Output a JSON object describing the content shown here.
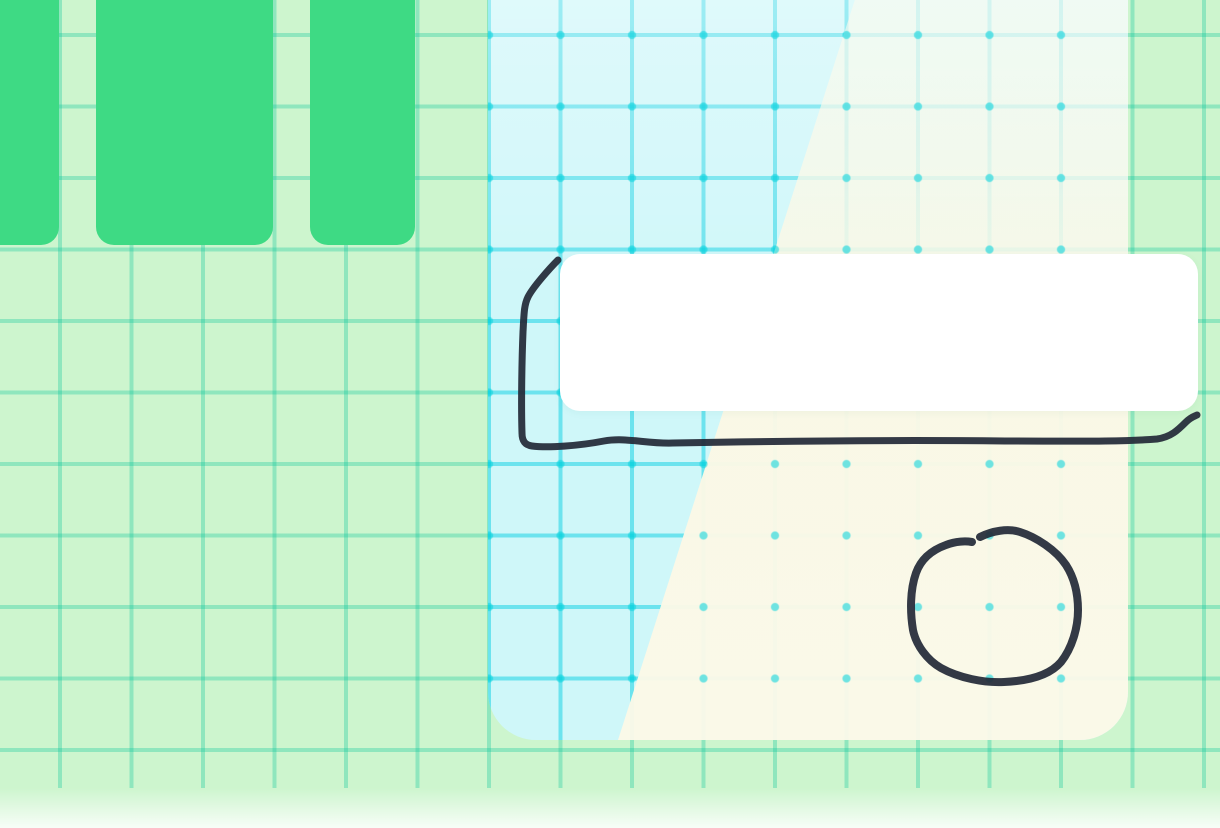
{
  "canvas": {
    "description": "whiteboard canvas with grid, green tiles, gradient panel, white card and hand-drawn ink annotations",
    "grid": {
      "cell_px": 71.5,
      "background_color": "#cdf5ce",
      "line_color_teal": "#00c396"
    },
    "colors": {
      "tile_green": "#3eda84",
      "panel_cyan": "#cff7f9",
      "panel_cream": "#fbf8e5",
      "panel_grid_cyan": "#00cde1",
      "panel_dot_cyan": "#00d2dc",
      "card_white": "#ffffff",
      "ink_dark": "#242a38"
    },
    "shapes": {
      "green_tiles_count": 3,
      "panel": "large rounded panel, cyan upper-left half and cream lower-right half split by a diagonal edge, with cyan grid lines and intersection dots",
      "card": "plain white rounded rectangle overlapping the panel"
    },
    "ink_strokes": {
      "frame": {
        "label": "hand-drawn open frame around the white card (left side and underline with upward hook at right end)",
        "width": 7,
        "path": "M 558 260 C 550 268, 533 287, 528 297 C 524 305, 524 314, 523 332 C 522 356, 521 402, 522 433 C 522 441, 525 445, 532 446 C 548 448, 578 446, 604 441 C 626 437, 647 444, 673 443 C 780 441, 910 440, 1005 441 C 1068 441, 1118 442, 1157 439 C 1171 437, 1178 430, 1186 422 C 1191 417, 1195 416, 1197 415"
      },
      "circle": {
        "label": "hand-drawn circle with small gap at top, lower right of panel",
        "width": 8,
        "path": "M 980 537 C 992 531, 1008 528, 1020 532 C 1036 537, 1056 550, 1066 565 C 1075 579, 1078 595, 1078 610 C 1078 628, 1072 648, 1061 662 C 1049 676, 1027 681, 1004 682 C 984 683, 959 678, 941 668 C 927 660, 916 645, 913 630 C 910 612, 910 590, 916 573 C 921 559, 932 550, 946 545 C 956 541, 966 541, 972 542"
      }
    }
  }
}
